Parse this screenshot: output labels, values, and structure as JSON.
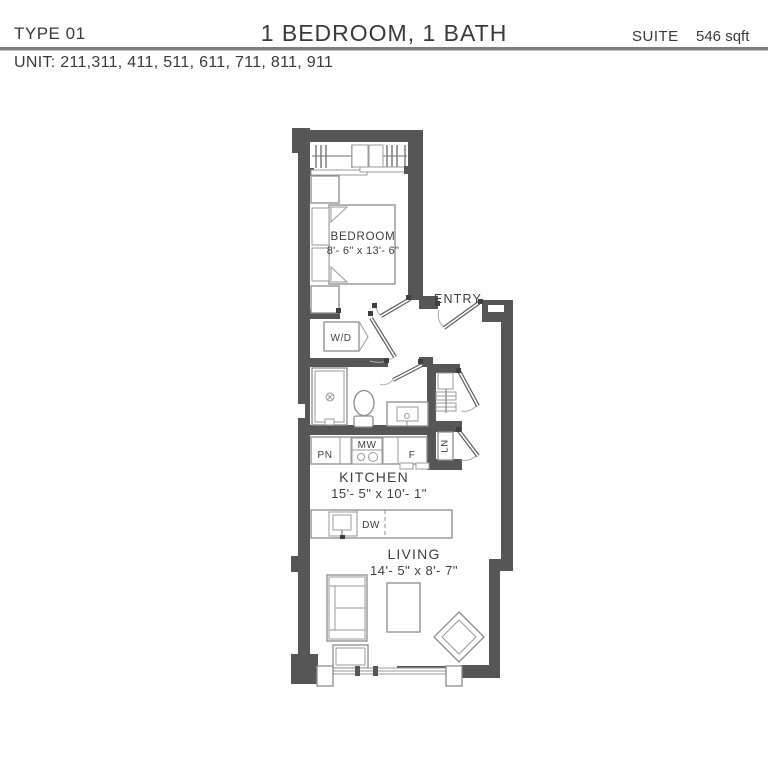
{
  "header": {
    "plan_type": "TYPE 01",
    "title": "1 BEDROOM, 1 BATH",
    "suite_label": "SUITE",
    "suite_area": "546 sqft",
    "unit_list": "UNIT: 211,311, 411, 511, 611, 711, 811, 911"
  },
  "plan": {
    "rooms": {
      "bedroom": {
        "label": "BEDROOM",
        "dims": "8'- 6\" x 13'- 6\""
      },
      "kitchen": {
        "label": "KITCHEN",
        "dims": "15'- 5\" x 10'- 1\""
      },
      "living": {
        "label": "LIVING",
        "dims": "14'- 5\" x 8'- 7\""
      },
      "entry": {
        "label": "ENTRY"
      }
    },
    "fixtures": {
      "washer_dryer": "W/D",
      "pantry": "PN",
      "microwave": "MW",
      "fridge": "F",
      "dishwasher": "DW",
      "linen": "LN"
    },
    "colors": {
      "wall": "#565656",
      "furniture_stroke": "#8c8c8c",
      "text": "#3a3a3a"
    }
  }
}
